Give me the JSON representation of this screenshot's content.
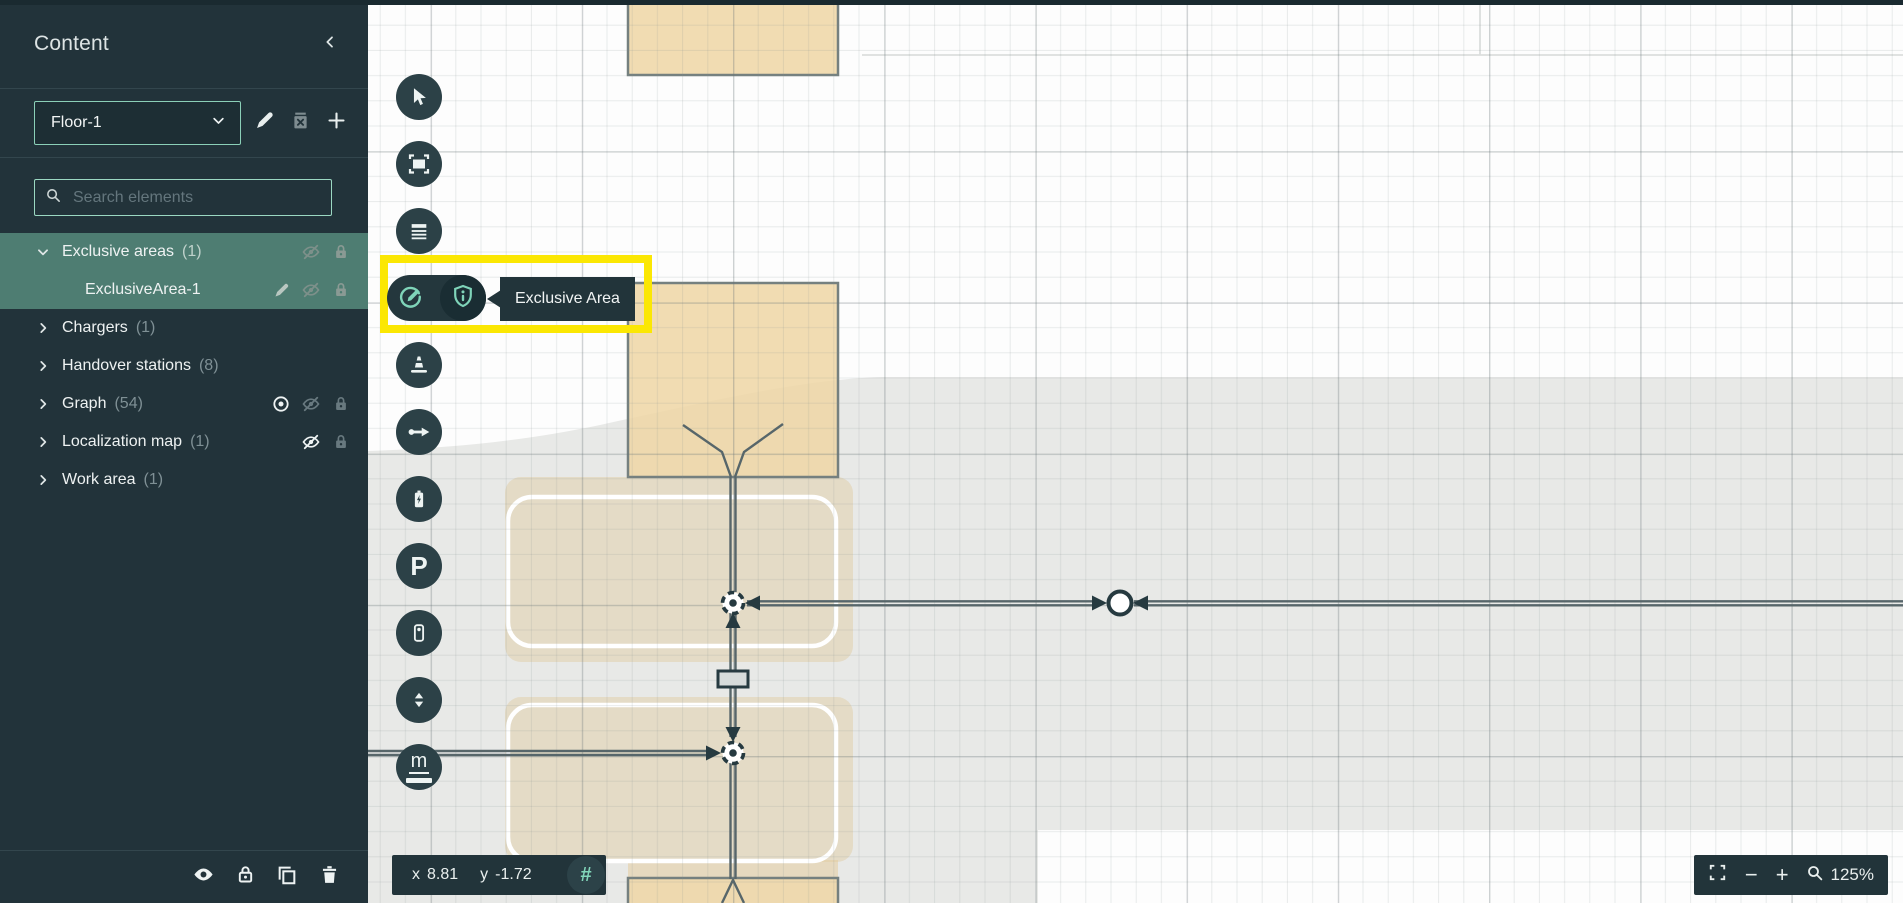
{
  "sidebar": {
    "title": "Content",
    "floor_selector": {
      "value": "Floor-1"
    },
    "search": {
      "placeholder": "Search elements"
    },
    "tree": {
      "rows": [
        {
          "label": "Exclusive areas",
          "count": "(1)"
        },
        {
          "label": "ExclusiveArea-1",
          "count": ""
        },
        {
          "label": "Chargers",
          "count": "(1)"
        },
        {
          "label": "Handover stations",
          "count": "(8)"
        },
        {
          "label": "Graph",
          "count": "(54)"
        },
        {
          "label": "Localization map",
          "count": "(1)"
        },
        {
          "label": "Work area",
          "count": "(1)"
        }
      ]
    }
  },
  "toolbar": {
    "active_tool_tooltip": "Exclusive Area",
    "measure_label": "m",
    "parking_label": "P"
  },
  "statusbar": {
    "x_label": "x",
    "x_value": "8.81",
    "y_label": "y",
    "y_value": "-1.72",
    "snap_glyph": "#"
  },
  "zoombar": {
    "minus_label": "−",
    "plus_label": "+",
    "zoom_level": "125%"
  },
  "colors": {
    "panel": "#22333a",
    "selection_green": "#4e7d72",
    "accent_mint": "#7fd4b9",
    "highlight_yellow": "#fbe703",
    "map_gray": "#e8e9e7",
    "area_tan": "#f0ddb4"
  }
}
